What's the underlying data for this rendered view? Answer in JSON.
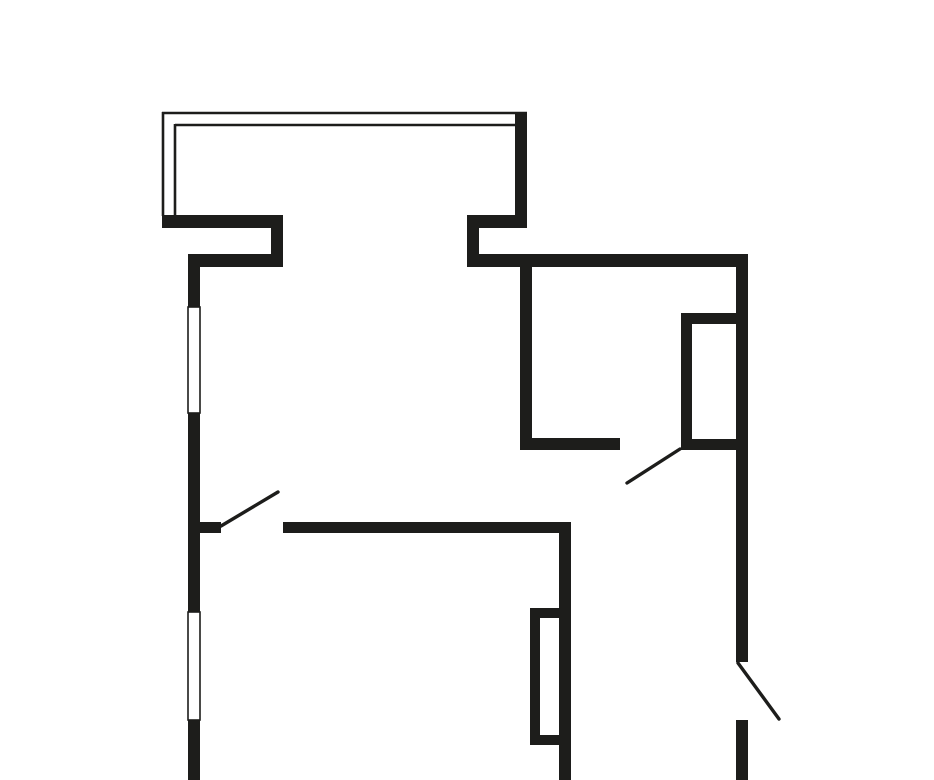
{
  "canvas": {
    "width": 934,
    "height": 780,
    "background": "#ffffff"
  },
  "style": {
    "wall_color": "#1d1d1b",
    "window_fill": "#ffffff",
    "window_stroke": "#1d1d1b",
    "window_stroke_width": 1.6,
    "railing_stroke": "#1d1d1b",
    "railing_width": 2.6,
    "door_stroke": "#1d1d1b",
    "door_width": 3.4
  },
  "walls": [
    {
      "name": "balcony-right-wall",
      "x": 515,
      "y": 114,
      "w": 12,
      "h": 114
    },
    {
      "name": "balcony-parapet-left",
      "x": 162,
      "y": 215,
      "w": 121,
      "h": 13
    },
    {
      "name": "wall-jog-left",
      "x": 271,
      "y": 215,
      "w": 12,
      "h": 52
    },
    {
      "name": "top-wall-left",
      "x": 188,
      "y": 254,
      "w": 95,
      "h": 13
    },
    {
      "name": "balcony-parapet-right",
      "x": 467,
      "y": 215,
      "w": 60,
      "h": 13
    },
    {
      "name": "wall-jog-right",
      "x": 467,
      "y": 215,
      "w": 12,
      "h": 52
    },
    {
      "name": "top-wall-right",
      "x": 467,
      "y": 254,
      "w": 281,
      "h": 13
    },
    {
      "name": "left-wall-upper",
      "x": 188,
      "y": 254,
      "w": 12,
      "h": 53
    },
    {
      "name": "left-wall-middle",
      "x": 188,
      "y": 413,
      "w": 12,
      "h": 199
    },
    {
      "name": "left-wall-lower",
      "x": 188,
      "y": 720,
      "w": 12,
      "h": 60
    },
    {
      "name": "right-wall-upper",
      "x": 736,
      "y": 254,
      "w": 12,
      "h": 408
    },
    {
      "name": "right-wall-lower",
      "x": 736,
      "y": 720,
      "w": 12,
      "h": 60
    },
    {
      "name": "kitchen-left-wall",
      "x": 520,
      "y": 267,
      "w": 12,
      "h": 183
    },
    {
      "name": "kitchen-bottom-wall",
      "x": 520,
      "y": 438,
      "w": 100,
      "h": 12
    },
    {
      "name": "kitchen-shaft-left",
      "x": 681,
      "y": 313,
      "w": 11,
      "h": 137
    },
    {
      "name": "kitchen-shaft-top",
      "x": 681,
      "y": 313,
      "w": 67,
      "h": 11
    },
    {
      "name": "kitchen-shaft-bottom",
      "x": 681,
      "y": 439,
      "w": 67,
      "h": 11
    },
    {
      "name": "hall-wall",
      "x": 283,
      "y": 522,
      "w": 285,
      "h": 11
    },
    {
      "name": "hall-wall-stub",
      "x": 188,
      "y": 522,
      "w": 33,
      "h": 11
    },
    {
      "name": "bedroom-right-wall",
      "x": 559,
      "y": 522,
      "w": 12,
      "h": 258
    },
    {
      "name": "bedroom-shaft-left",
      "x": 530,
      "y": 608,
      "w": 10,
      "h": 137
    },
    {
      "name": "bedroom-shaft-top",
      "x": 530,
      "y": 608,
      "w": 30,
      "h": 10
    },
    {
      "name": "bedroom-shaft-bottom",
      "x": 530,
      "y": 735,
      "w": 30,
      "h": 10
    }
  ],
  "windows": [
    {
      "name": "window-living-room",
      "x": 188,
      "y": 307,
      "w": 12,
      "h": 106
    },
    {
      "name": "window-bedroom",
      "x": 188,
      "y": 612,
      "w": 12,
      "h": 108
    }
  ],
  "balcony_railing": [
    {
      "name": "balcony-rail-outer-top",
      "x1": 162,
      "y1": 113,
      "x2": 527,
      "y2": 113
    },
    {
      "name": "balcony-rail-outer-left",
      "x1": 163,
      "y1": 112,
      "x2": 163,
      "y2": 216
    },
    {
      "name": "balcony-rail-inner-top",
      "x1": 175,
      "y1": 125,
      "x2": 516,
      "y2": 125
    },
    {
      "name": "balcony-rail-inner-left",
      "x1": 175,
      "y1": 124,
      "x2": 175,
      "y2": 216
    }
  ],
  "door_leaves": [
    {
      "name": "door-leaf-kitchen",
      "x1": 680,
      "y1": 449,
      "x2": 627,
      "y2": 483
    },
    {
      "name": "door-leaf-room",
      "x1": 221,
      "y1": 526,
      "x2": 278,
      "y2": 492
    },
    {
      "name": "door-leaf-entrance",
      "x1": 738,
      "y1": 663,
      "x2": 779,
      "y2": 719
    }
  ]
}
